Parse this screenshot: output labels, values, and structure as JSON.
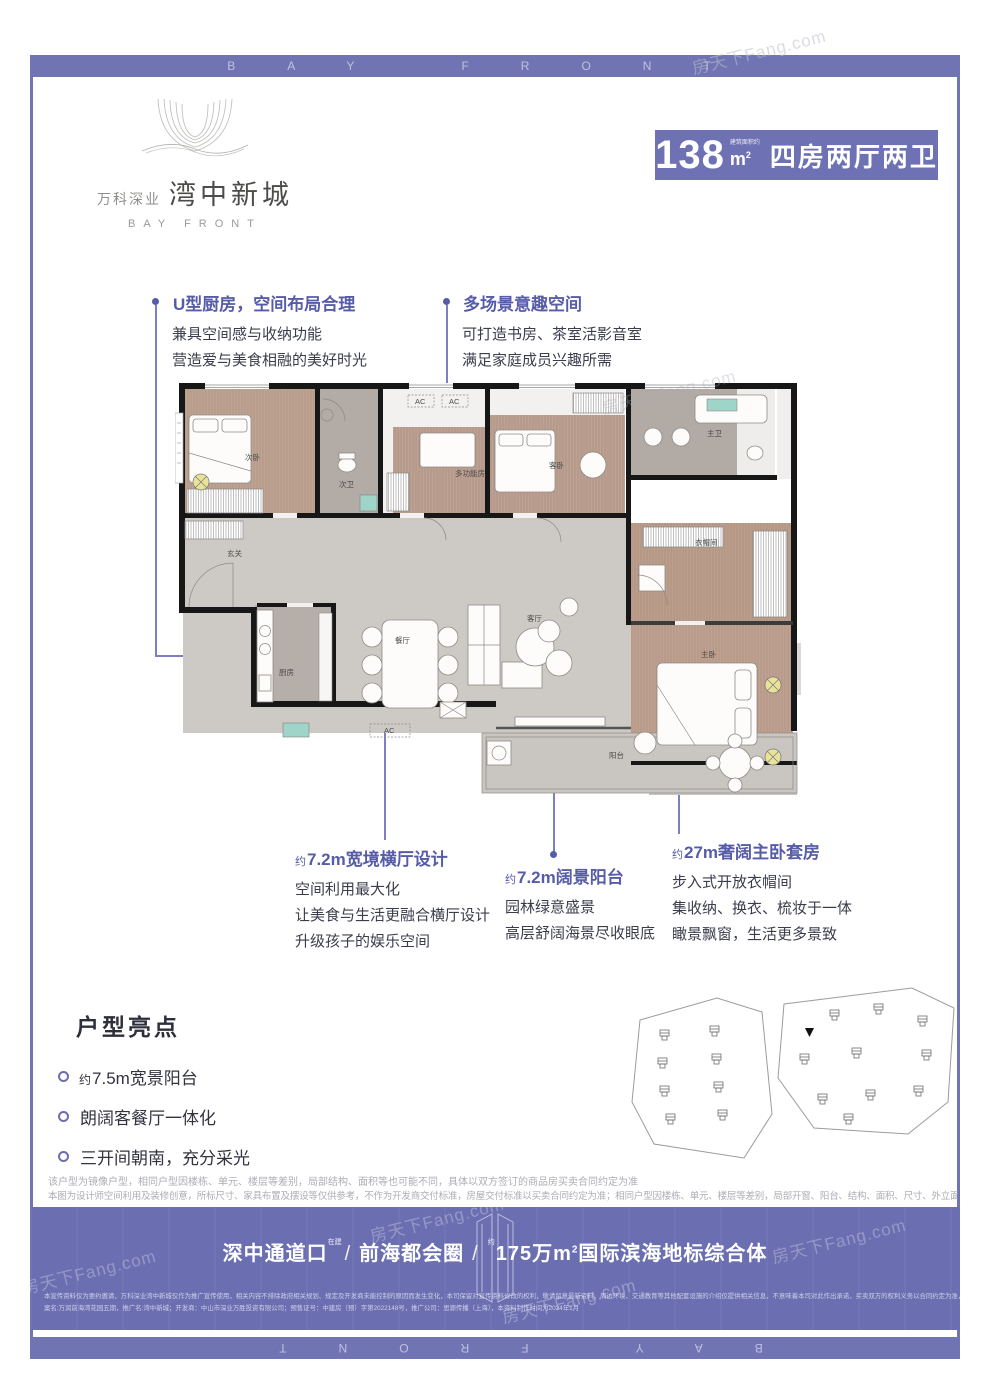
{
  "frame": {
    "banner_text": "BAY FRONT"
  },
  "watermark": {
    "text": "房天下Fang.com"
  },
  "logo": {
    "brand": "万科深业",
    "name": "湾中新城",
    "en": "BAY FRONT"
  },
  "badge": {
    "area": "138",
    "area_note": "建筑面积约",
    "unit": "m",
    "unit_sup": "2",
    "layout": "四房两厅两卫"
  },
  "annotations": [
    {
      "prefix": "",
      "title": "U型厨房，空间布局合理",
      "lines": [
        "兼具空间感与收纳功能",
        "营造爱与美食相融的美好时光"
      ]
    },
    {
      "prefix": "",
      "title": "多场景意趣空间",
      "lines": [
        "可打造书房、茶室活影音室",
        "满足家庭成员兴趣所需"
      ]
    },
    {
      "prefix": "约",
      "title": "7.2m宽境横厅设计",
      "lines": [
        "空间利用最大化",
        "让美食与生活更融合横厅设计",
        "升级孩子的娱乐空间"
      ]
    },
    {
      "prefix": "约",
      "title": "7.2m阔景阳台",
      "lines": [
        "园林绿意盛景",
        "高层舒阔海景尽收眼底"
      ]
    },
    {
      "prefix": "约",
      "title": "27m奢阔主卧套房",
      "lines": [
        "步入式开放衣帽间",
        "集收纳、换衣、梳妆于一体",
        "瞰景飘窗，生活更多景致"
      ]
    }
  ],
  "floorplan": {
    "rooms": [
      "次卧",
      "次卫",
      "多功能房",
      "客卧",
      "主卫",
      "玄关",
      "厨房",
      "餐厅",
      "客厅",
      "衣帽间",
      "主卧",
      "阳台"
    ],
    "ac": "AC"
  },
  "highlights": {
    "title": "户型亮点",
    "items": [
      {
        "prefix": "约",
        "text": "7.5m宽景阳台"
      },
      {
        "prefix": "",
        "text": "朗阔客餐厅一体化"
      },
      {
        "prefix": "",
        "text": "三开间朝南，充分采光"
      }
    ]
  },
  "disclaimer": {
    "line1": "该户型为镜像户型，相同户型因楼栋、单元、楼层等差别，局部结构、面积等也可能不同，具体以双方签订的商品房买卖合同约定为准",
    "line2": "本图为设计师空间利用及装修创意，所标尺寸、家具布置及摆设等仅供参考，不作为开发商交付标准，房屋交付标准以买卖合同约定为准；相同户型因楼栋、单元、楼层等差别，局部开窗、阳台、结构、面积、尺寸、外立面等可能不同。"
  },
  "banner": {
    "loc1": "深中通道口",
    "loc1_note": "在建",
    "sep": "/",
    "loc2": "前海都会圈",
    "loc3_prefix": "约",
    "loc3_main": "175万m",
    "loc3_sup": "2",
    "loc3_rest": "国际滨海地标综合体"
  },
  "legal": {
    "line1": "本宣传资料仅为要约邀请，万科深业湾中新城仅作为推广宣传使用，相关内容不排除政府相关规划、规定及开发商未能控制的原因而发生变化，本司保留对宣传资料修改的权利，敬请留意最新资料，周边环境、交通教育等其他配套设施的介绍仅提供相关信息，不意味着本司对此作出承诺，买卖双方的权利义务以合同约定为准，备",
    "line2": "案名:万润前海湾花园五期，推广名:湾中新城；开发商：中山市深业万胜投资有限公司；预售证号：中建房（预）字第2022148号，推广公司：思源传播（上海），本资料制作时间为2024年1月"
  }
}
